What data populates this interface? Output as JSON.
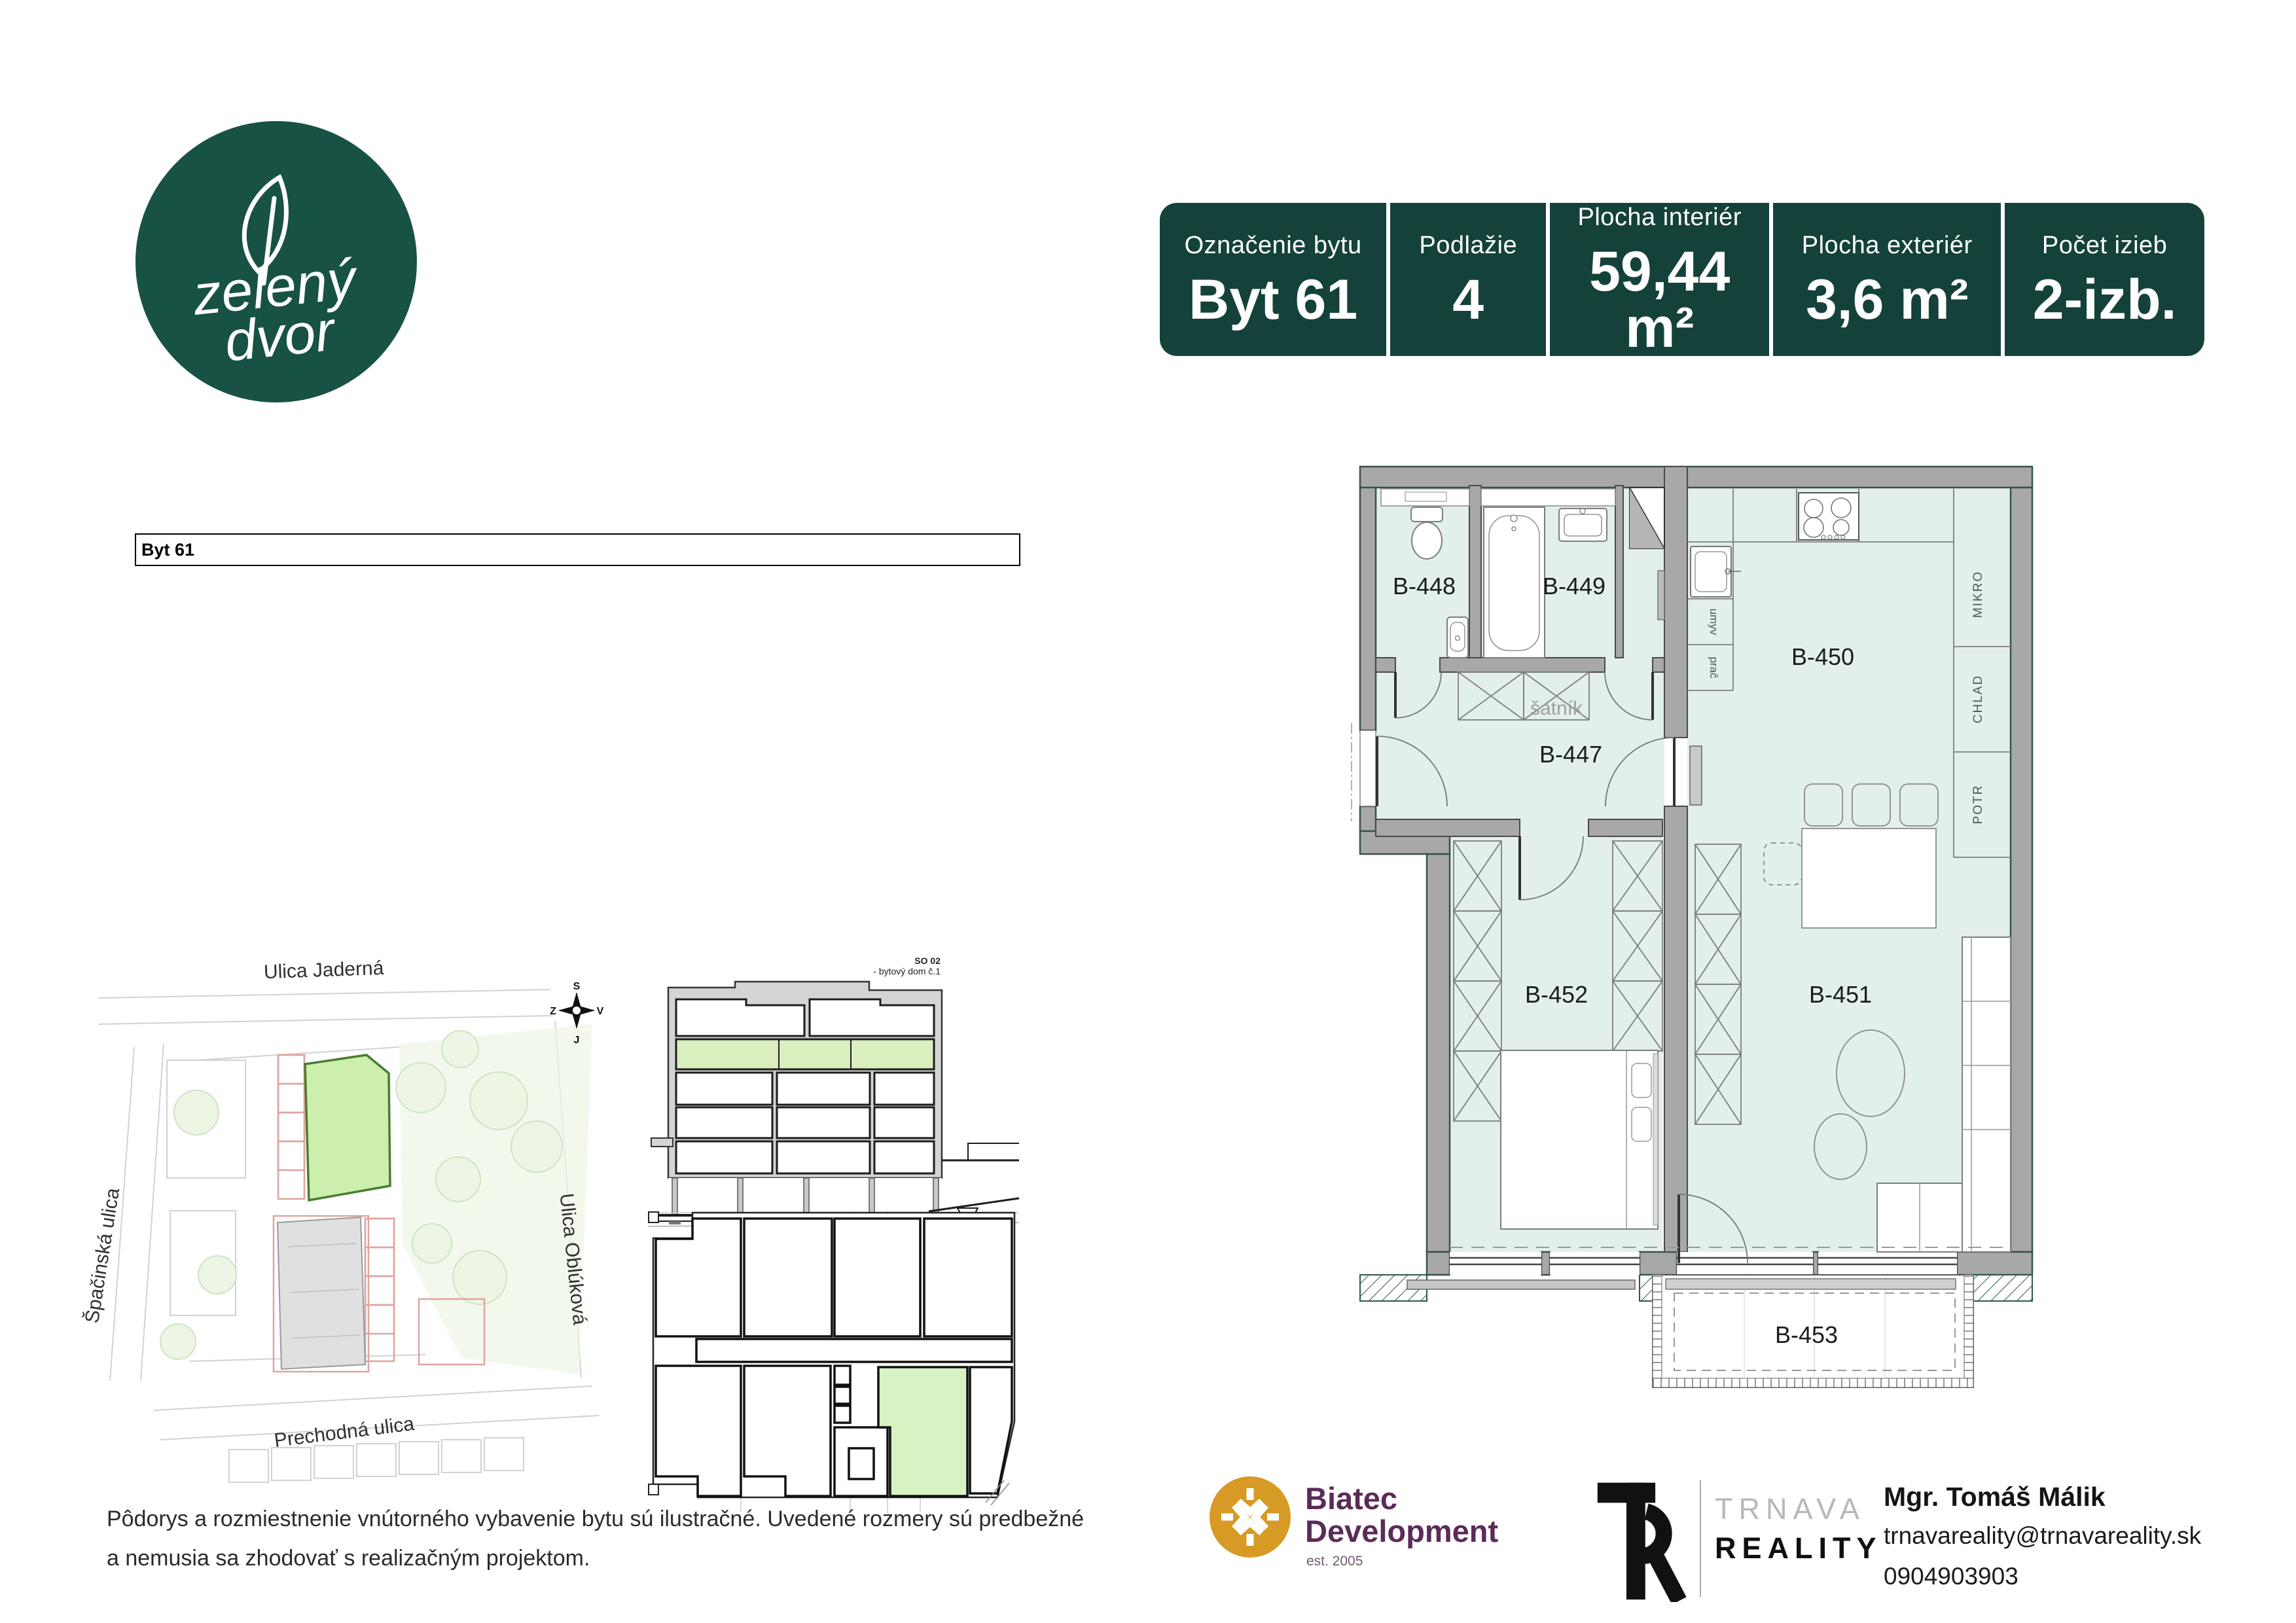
{
  "colors": {
    "brand_green": "#14423a",
    "logo_green": "#175245",
    "plan_room_fill": "#e2efed",
    "plan_wall": "#a8a8a8",
    "highlight_green": "#cdefad",
    "section_green": "#d9efbe",
    "biatec_orange": "#d79a24",
    "biatec_purple": "#5b2b58",
    "comment_triangle_green": "#2f9e41"
  },
  "logo": {
    "line1": "zelený",
    "line2": "dvor"
  },
  "header": {
    "cells": [
      {
        "label": "Označenie bytu",
        "value": "Byt 61"
      },
      {
        "label": "Podlažie",
        "value": "4"
      },
      {
        "label": "Plocha interiér",
        "value": "59,44 m²"
      },
      {
        "label": "Plocha exteriér",
        "value": "3,6 m²"
      },
      {
        "label": "Počet izieb",
        "value": "2-izb."
      }
    ]
  },
  "table": {
    "title": "Byt 61",
    "rows": [
      [
        "B-447",
        "Chodba",
        "6,545",
        "P7",
        "Parkety lamino",
        "Váp.-sádrová",
        "Váp.-sádrová",
        ""
      ],
      [
        "B-448",
        "WC",
        "2,062",
        "P7",
        "Gress.dlažba",
        "Váp.-cement.\npodhoz pod obklad",
        "Váp.-sádrová",
        "Gress. obklad"
      ],
      [
        "B-449",
        "Kúpeľňa",
        "3,932",
        "P7",
        "Gress.dlažba",
        "Váp.-cement.\npodhoz pod obklad",
        "Váp.-sádrová",
        "Gress. obklad"
      ],
      [
        "B-450",
        "Kuchyňa",
        "8,575",
        "P7",
        "Parkety lamino",
        "Váp.-sádrová",
        "Váp.-sádrová",
        ""
      ],
      [
        "B-451",
        "Obývacia izba",
        "24,500",
        "P7",
        "Parkety lamino",
        "Váp.-sádrová",
        "Váp.-sádrová",
        ""
      ],
      [
        "B-452",
        "Izba",
        "13,807",
        "P7",
        "Parkety lamino",
        "Váp.-sádrová",
        "Váp.-sádrová",
        ""
      ],
      [
        "B-453",
        "Lódžia",
        "3,600",
        "S2.1",
        "Betón. dlažba",
        "ETICS-kompl. zatep.\nsyst. silikón. omietka",
        "",
        ""
      ]
    ],
    "summary": [
      {
        "label": "Spolu úžitková plocha bytu",
        "value": "59,440"
      },
      {
        "label": "Spolu celková plocha bytu",
        "value": "63,040"
      }
    ]
  },
  "site_map": {
    "street_top": "Ulica Jaderná",
    "street_left": "Špačinská ulica",
    "street_right": "Ulica Oblúková",
    "street_bottom": "Prechodná ulica",
    "compass": {
      "n": "S",
      "e": "V",
      "s": "J",
      "w": "Z"
    }
  },
  "section": {
    "line1": "SO 02",
    "line2": "- bytový dom č.1"
  },
  "floor_plan": {
    "rooms": {
      "b447": "B-447",
      "b448": "B-448",
      "b449": "B-449",
      "b450": "B-450",
      "b451": "B-451",
      "b452": "B-452",
      "b453": "B-453"
    },
    "labels": {
      "satnik": "šatník",
      "umyv": "umyv",
      "prac": "prač",
      "mikro": "MIKRO",
      "chlad": "CHLAD",
      "potr": "POTR"
    }
  },
  "footer": {
    "disclaimer1": "Pôdorys a rozmiestnenie vnútorného vybavenie bytu sú ilustračné. Uvedené rozmery sú predbežné",
    "disclaimer2": "a nemusia sa zhodovať s realizačným projektom.",
    "biatec": {
      "line1": "Biatec",
      "line2": "Development",
      "est": "est. 2005"
    },
    "trnava": {
      "line1": "TRNAVA",
      "line2": "REALITY"
    },
    "agent": {
      "name": "Mgr. Tomáš Málik",
      "email": "trnavareality@trnavareality.sk",
      "phone": "0904903903"
    }
  }
}
